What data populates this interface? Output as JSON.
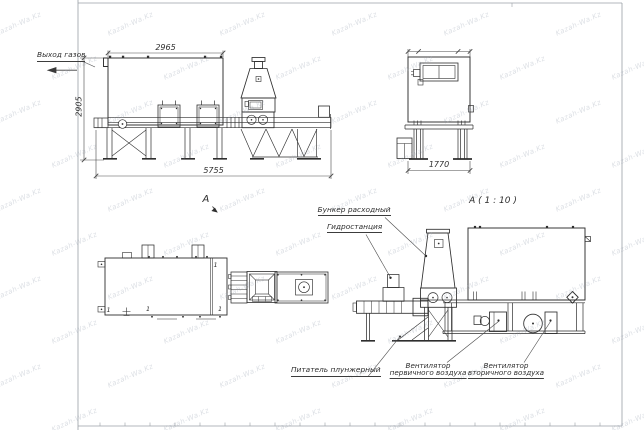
{
  "drawing": {
    "watermark": {
      "text": "Kazah-Wa.Kz"
    },
    "front_view": {
      "label_gas_outlet": "Выход газов",
      "dim_width_top": "2965",
      "dim_height_left": "2905",
      "dim_width_bottom": "5755"
    },
    "end_view": {
      "dim_width_bottom": "1770"
    },
    "plan_view": {
      "view_arrow_label": "А",
      "position_marker": "1"
    },
    "section_view": {
      "title": "А ( 1 : 10 )",
      "label_supply_hopper": "Бункер расходный",
      "label_hydraulic_station": "Гидростанция",
      "label_plunger_feeder": "Питатель плунжерный",
      "label_primary_air_fan_line1": "Вентилятор",
      "label_primary_air_fan_line2": "первичного воздуха",
      "label_secondary_air_fan_line1": "Вентилятор",
      "label_secondary_air_fan_line2": "вторичного воздуха"
    }
  }
}
